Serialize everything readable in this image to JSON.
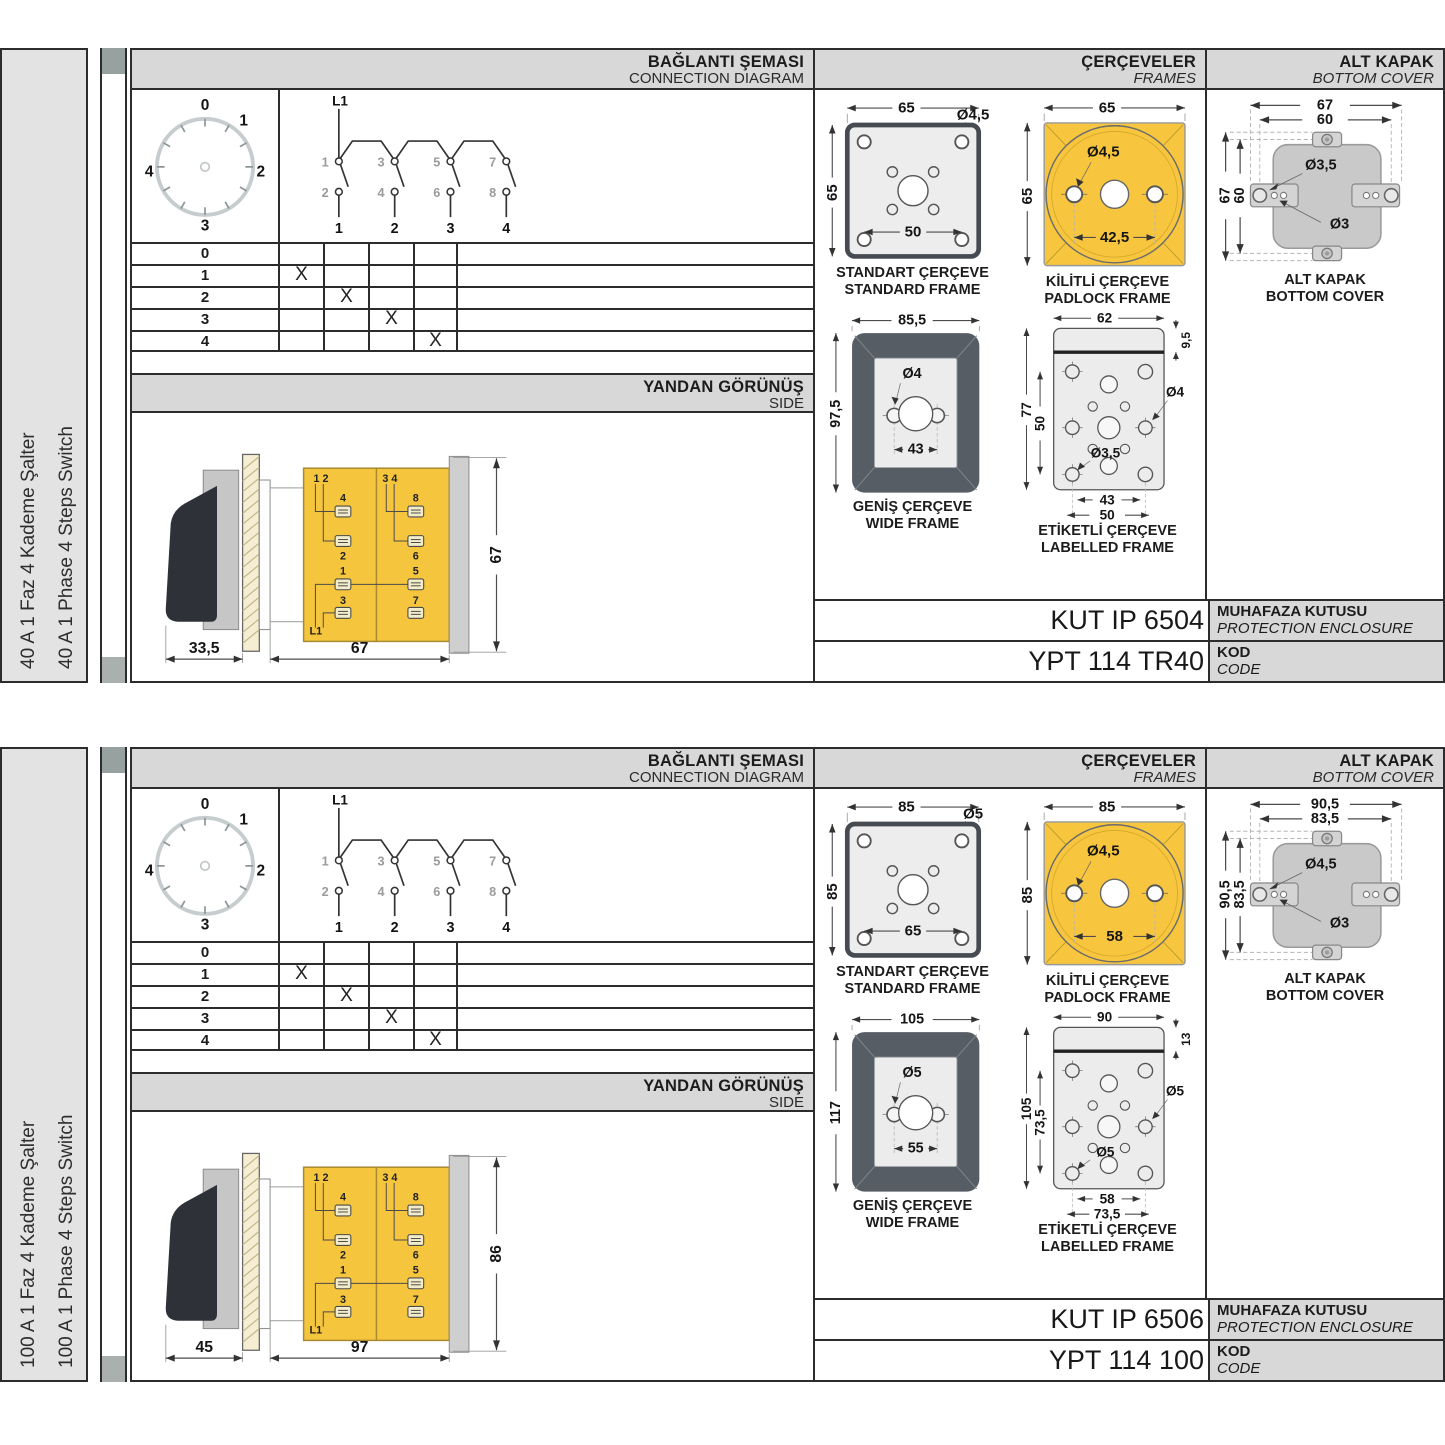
{
  "sections": [
    {
      "side_labels": {
        "tr": "40 A 1 Faz 4 Kademe Şalter",
        "en": "40 A 1 Phase 4 Steps Switch"
      },
      "connection": {
        "title_tr": "BAĞLANTI ŞEMASI",
        "title_en": "CONNECTION DIAGRAM",
        "dial_labels": [
          "0",
          "1",
          "2",
          "3",
          "4"
        ],
        "schematic": {
          "phase": "L1",
          "poles": [
            {
              "top": "1",
              "bottom": "2",
              "terminal": "1"
            },
            {
              "top": "3",
              "bottom": "4",
              "terminal": "2"
            },
            {
              "top": "5",
              "bottom": "6",
              "terminal": "3"
            },
            {
              "top": "7",
              "bottom": "8",
              "terminal": "4"
            }
          ]
        },
        "table_rows": [
          {
            "step": "0",
            "marks": [
              "",
              "",
              "",
              ""
            ]
          },
          {
            "step": "1",
            "marks": [
              "X",
              "",
              "",
              ""
            ]
          },
          {
            "step": "2",
            "marks": [
              "",
              "X",
              "",
              ""
            ]
          },
          {
            "step": "3",
            "marks": [
              "",
              "",
              "X",
              ""
            ]
          },
          {
            "step": "4",
            "marks": [
              "",
              "",
              "",
              "X"
            ]
          }
        ]
      },
      "side_view": {
        "title_tr": "YANDAN GÖRÜNÜŞ",
        "title_en": "SIDE",
        "dims": {
          "handle": "33,5",
          "depth": "67",
          "height": "67"
        },
        "terminals": {
          "left_pair": "1 2",
          "right_pair": "3 4",
          "phase": "L1",
          "left_col": [
            "4",
            "2",
            "1",
            "3"
          ],
          "right_col": [
            "8",
            "6",
            "5",
            "7"
          ]
        }
      },
      "frames": {
        "title_tr": "ÇERÇEVELER",
        "title_en": "FRAMES",
        "standard": {
          "caption_tr": "STANDART ÇERÇEVE",
          "caption_en": "STANDARD FRAME",
          "width": "65",
          "height": "65",
          "hole": "Ø4,5",
          "pitch": "50"
        },
        "padlock": {
          "caption_tr": "KİLİTLİ ÇERÇEVE",
          "caption_en": "PADLOCK FRAME",
          "width": "65",
          "height": "65",
          "hole": "Ø4,5",
          "pitch": "42,5"
        },
        "wide": {
          "caption_tr": "GENİŞ ÇERÇEVE",
          "caption_en": "WIDE FRAME",
          "width": "85,5",
          "height": "97,5",
          "hole": "Ø4",
          "pitch": "43"
        },
        "labelled": {
          "caption_tr": "ETİKETLİ ÇERÇEVE",
          "caption_en": "LABELLED FRAME",
          "width": "62",
          "strip": "9,5",
          "height": "77",
          "hole_pitch_v": "50",
          "hole_right": "Ø4",
          "hole_left": "Ø3,5",
          "pitch1": "43",
          "pitch2": "50"
        }
      },
      "cover": {
        "title_tr": "ALT KAPAK",
        "title_en": "BOTTOM COVER",
        "caption_tr": "ALT KAPAK",
        "caption_en": "BOTTOM COVER",
        "dim_w_outer": "67",
        "dim_w_inner": "60",
        "dim_h_outer": "67",
        "dim_h_inner": "60",
        "hole_big": "Ø3,5",
        "hole_small": "Ø3"
      },
      "codes": {
        "enclosure": "KUT IP 6504",
        "enclosure_tr": "MUHAFAZA KUTUSU",
        "enclosure_en": "PROTECTION ENCLOSURE",
        "product": "YPT 114 TR40",
        "kod_tr": "KOD",
        "kod_en": "CODE"
      }
    },
    {
      "side_labels": {
        "tr": "100 A 1 Faz 4 Kademe Şalter",
        "en": "100 A 1 Phase 4 Steps Switch"
      },
      "connection": {
        "title_tr": "BAĞLANTI ŞEMASI",
        "title_en": "CONNECTION DIAGRAM",
        "dial_labels": [
          "0",
          "1",
          "2",
          "3",
          "4"
        ],
        "schematic": {
          "phase": "L1",
          "poles": [
            {
              "top": "1",
              "bottom": "2",
              "terminal": "1"
            },
            {
              "top": "3",
              "bottom": "4",
              "terminal": "2"
            },
            {
              "top": "5",
              "bottom": "6",
              "terminal": "3"
            },
            {
              "top": "7",
              "bottom": "8",
              "terminal": "4"
            }
          ]
        },
        "table_rows": [
          {
            "step": "0",
            "marks": [
              "",
              "",
              "",
              ""
            ]
          },
          {
            "step": "1",
            "marks": [
              "X",
              "",
              "",
              ""
            ]
          },
          {
            "step": "2",
            "marks": [
              "",
              "X",
              "",
              ""
            ]
          },
          {
            "step": "3",
            "marks": [
              "",
              "",
              "X",
              ""
            ]
          },
          {
            "step": "4",
            "marks": [
              "",
              "",
              "",
              "X"
            ]
          }
        ]
      },
      "side_view": {
        "title_tr": "YANDAN GÖRÜNÜŞ",
        "title_en": "SIDE",
        "dims": {
          "handle": "45",
          "depth": "97",
          "height": "86"
        },
        "terminals": {
          "left_pair": "1 2",
          "right_pair": "3 4",
          "phase": "L1",
          "left_col": [
            "4",
            "2",
            "1",
            "3"
          ],
          "right_col": [
            "8",
            "6",
            "5",
            "7"
          ]
        }
      },
      "frames": {
        "title_tr": "ÇERÇEVELER",
        "title_en": "FRAMES",
        "standard": {
          "caption_tr": "STANDART ÇERÇEVE",
          "caption_en": "STANDARD FRAME",
          "width": "85",
          "height": "85",
          "hole": "Ø5",
          "pitch": "65"
        },
        "padlock": {
          "caption_tr": "KİLİTLİ ÇERÇEVE",
          "caption_en": "PADLOCK FRAME",
          "width": "85",
          "height": "85",
          "hole": "Ø4,5",
          "pitch": "58"
        },
        "wide": {
          "caption_tr": "GENİŞ ÇERÇEVE",
          "caption_en": "WIDE FRAME",
          "width": "105",
          "height": "117",
          "hole": "Ø5",
          "pitch": "55"
        },
        "labelled": {
          "caption_tr": "ETİKETLİ ÇERÇEVE",
          "caption_en": "LABELLED FRAME",
          "width": "90",
          "strip": "13",
          "height": "105",
          "hole_pitch_v": "73,5",
          "hole_right": "Ø5",
          "hole_left": "Ø5",
          "pitch1": "58",
          "pitch2": "73,5"
        }
      },
      "cover": {
        "title_tr": "ALT KAPAK",
        "title_en": "BOTTOM COVER",
        "caption_tr": "ALT KAPAK",
        "caption_en": "BOTTOM COVER",
        "dim_w_outer": "90,5",
        "dim_w_inner": "83,5",
        "dim_h_outer": "90,5",
        "dim_h_inner": "83,5",
        "hole_big": "Ø4,5",
        "hole_small": "Ø3"
      },
      "codes": {
        "enclosure": "KUT IP 6506",
        "enclosure_tr": "MUHAFAZA KUTUSU",
        "enclosure_en": "PROTECTION ENCLOSURE",
        "product": "YPT 114 100",
        "kod_tr": "KOD",
        "kod_en": "CODE"
      }
    }
  ]
}
